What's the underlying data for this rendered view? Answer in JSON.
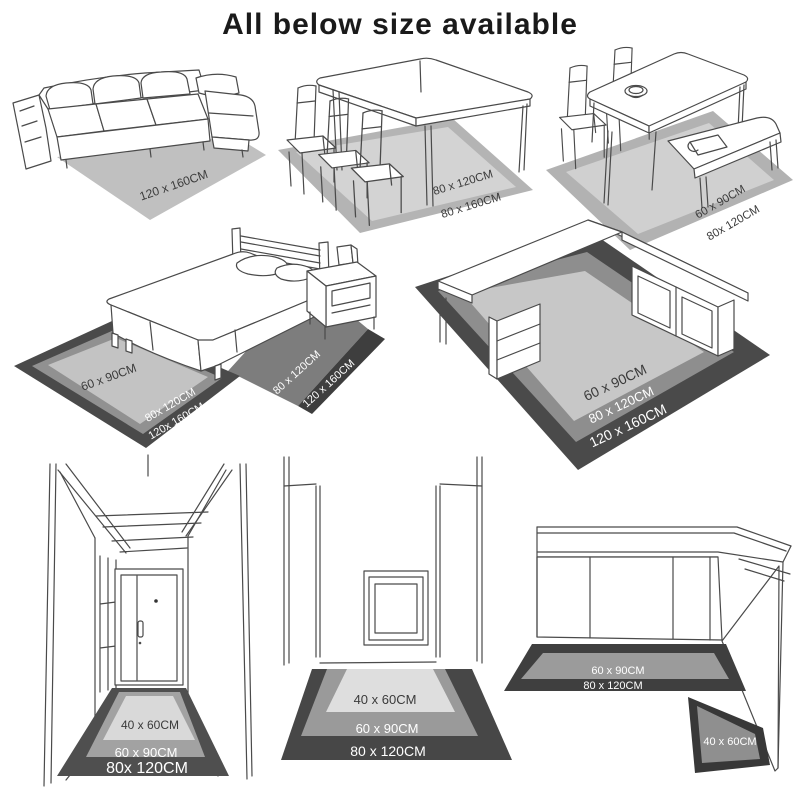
{
  "title": "All below size available",
  "colors": {
    "ink": "#4a4a4a",
    "label_dark": "#3a3a3a",
    "label_light": "#ffffff",
    "rug_light": "#c7c7c7",
    "rug_medium": "#8e8e8e",
    "rug_dark": "#4a4a4a"
  },
  "scenes": {
    "sofa": {
      "sizes": [
        "120 x 160CM"
      ]
    },
    "dining_table": {
      "sizes": [
        "80 x 120CM",
        "80 x 160CM"
      ]
    },
    "dining_bench": {
      "sizes": [
        "60 x 90CM",
        "80x 120CM"
      ]
    },
    "bedroom": {
      "foot_rug_sizes": [
        "60 x 90CM",
        "80x 120CM",
        "120x 160CM"
      ],
      "side_rug_sizes": [
        "80 x 120CM",
        "120 x 160CM"
      ]
    },
    "desk": {
      "sizes": [
        "60 x 90CM",
        "80 x 120CM",
        "120 x 160CM"
      ]
    },
    "hallway": {
      "sizes": [
        "40 x 60CM",
        "60 x 90CM",
        "80x 120CM"
      ]
    },
    "corridor": {
      "sizes": [
        "40 x 60CM",
        "60 x 90CM",
        "80 x 120CM"
      ]
    },
    "kitchen": {
      "runner_sizes": [
        "60 x 90CM",
        "80 x 120CM"
      ],
      "mat_sizes": [
        "40 x 60CM"
      ]
    }
  }
}
